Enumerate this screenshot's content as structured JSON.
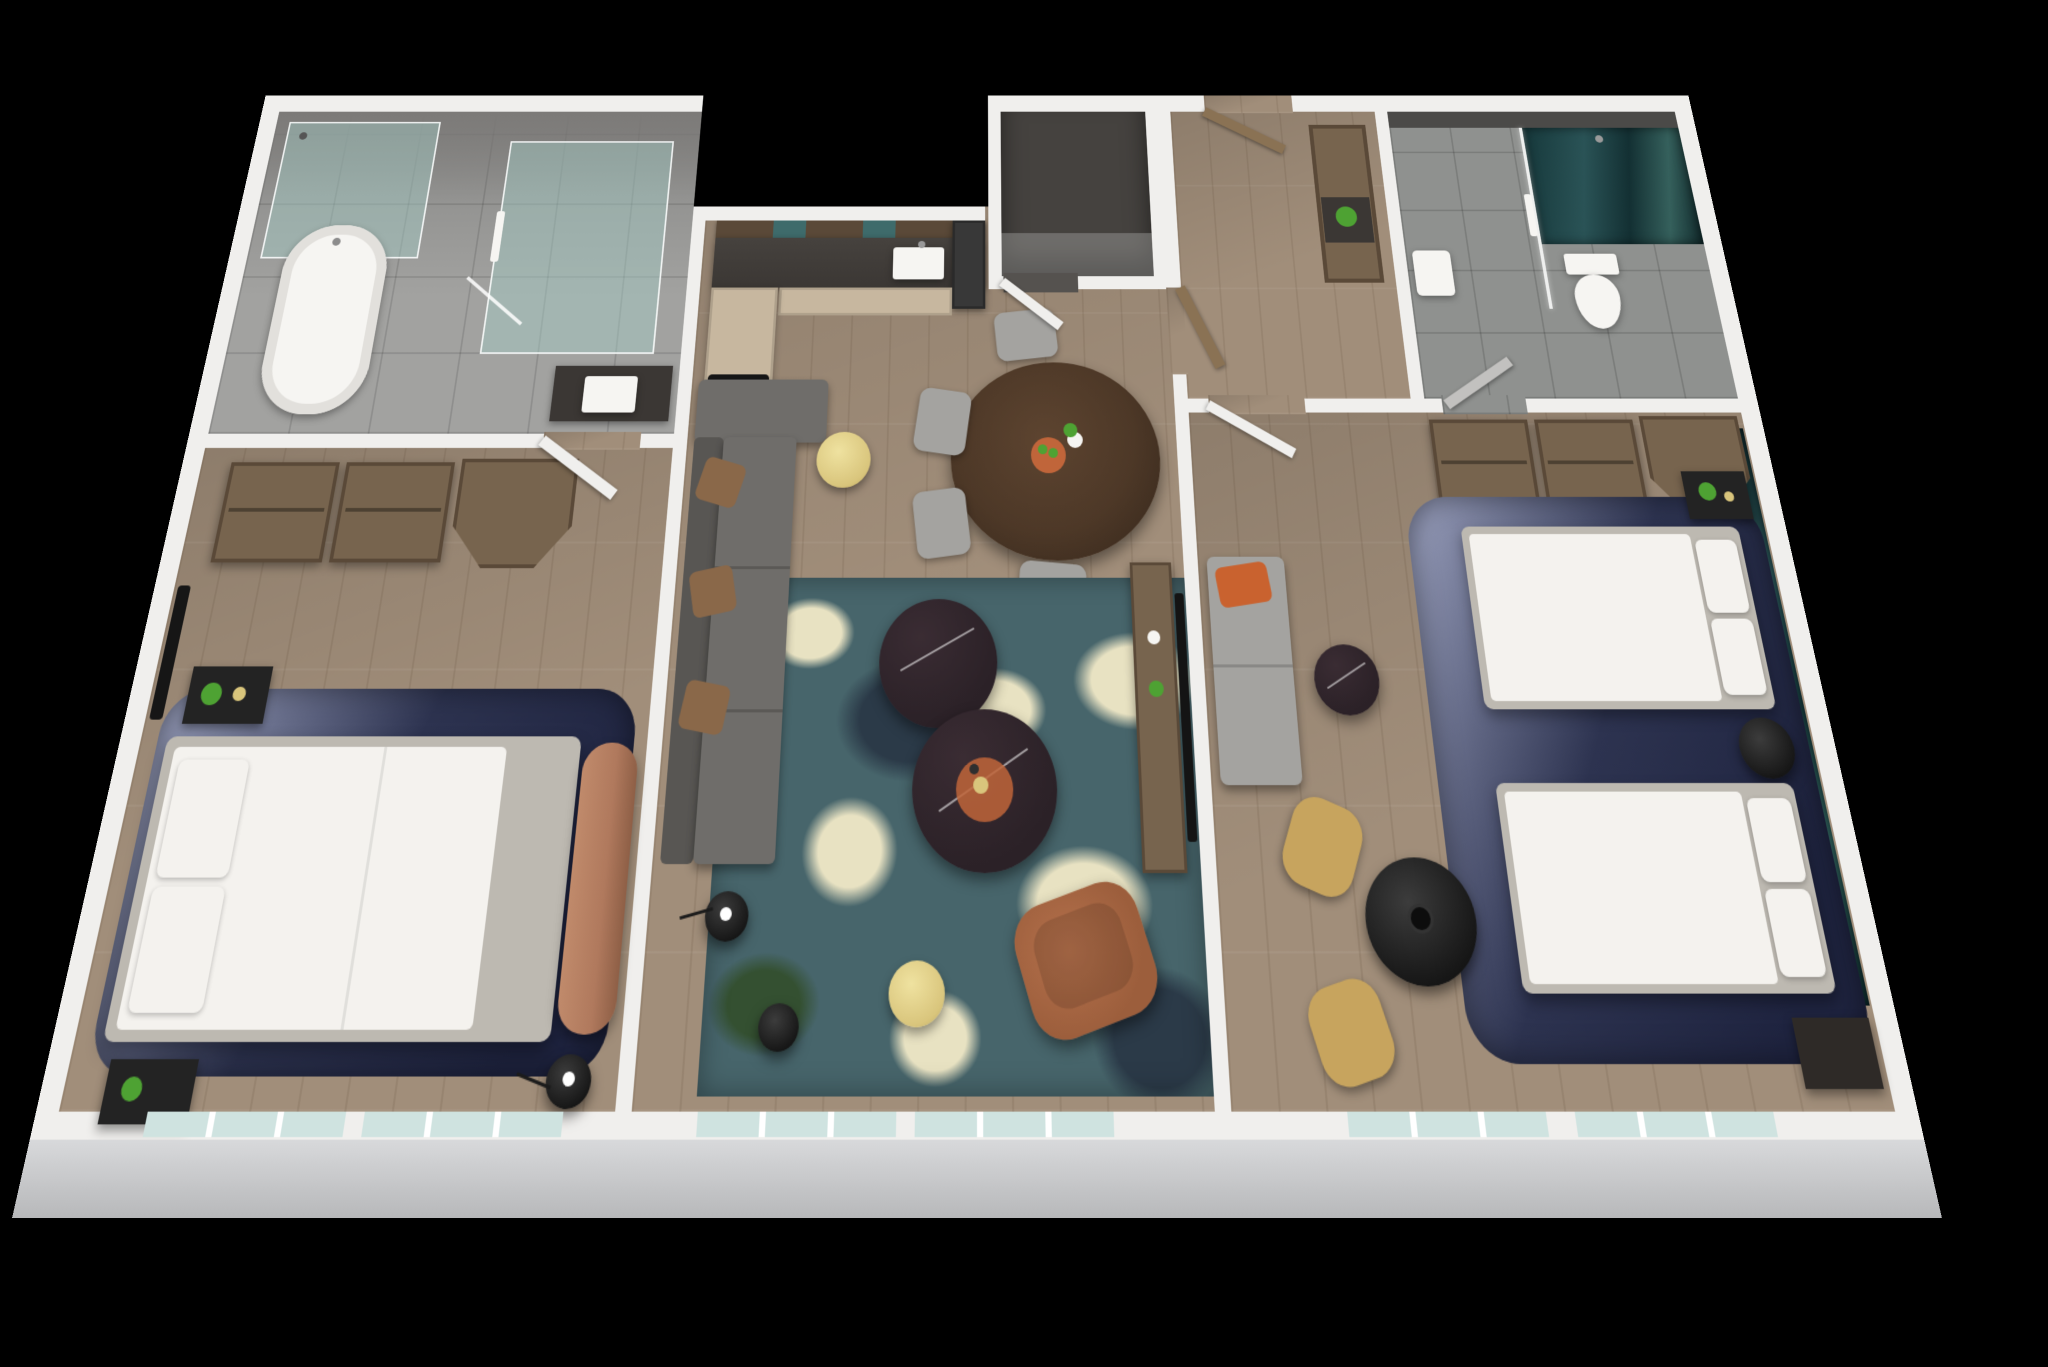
{
  "scene": {
    "type": "3d-floorplan-render",
    "description": "Isometric top-down 3D rendering of a two-bedroom hotel suite with white cut walls on a black background",
    "background": "#000000",
    "view": "angled top-down perspective, windows along the front (bottom) wall"
  },
  "palette": {
    "wall": "#f0efed",
    "exteriorFaceTop": "#d8d9db",
    "exteriorFaceBottom": "#b7b8ba",
    "blackVoid": "#000000",
    "woodFloor": "#a18e7a",
    "tileFloor": "#a2a2a0",
    "tileFloor2": "#8f918f",
    "darkWallFace": "#7c7a78",
    "closetInterior": "#45423f",
    "stoneCounter": "#3b3734",
    "cabinetBeige": "#c7b79f",
    "woodCabinet": "#77644e",
    "woodCabinetDark": "#5a4938",
    "tealGlassCabinet": "#3e6b6b",
    "applianceDark": "#383838",
    "glassTint": "rgba(164,205,198,0.45)",
    "glassEdge": "rgba(255,255,255,0.85)",
    "tealDeep": "#1d3d40",
    "navyRug": "#2d3350",
    "navyRugLight": "#8d93b0",
    "rugTeal": "#47656b",
    "rugCream": "#e8e2c2",
    "rugNavy": "#2b3a48",
    "rugGreen": "#345031",
    "sofaGray": "#6f6d6a",
    "sofaGrayDark": "#585653",
    "pillowBrown": "#8a6849",
    "leatherChair": "#9c5e3c",
    "copperBench": "#b0795d",
    "gold": "#d9c57c",
    "marbleDark": "#2b2127",
    "mattressWhite": "#f4f2ee",
    "bedFrame": "#bdb9b1",
    "matteBlack": "#232323",
    "mustard": "#c7a45e",
    "chairGray": "#a4a3a0",
    "plantGreen": "#4ea233",
    "terracotta": "#c0653a",
    "orangePillow": "#c9622f",
    "windowGlass": "#cfe3e0",
    "doorWood": "#8a7254",
    "white": "#f6f5f2",
    "diningWood": "#4d3827"
  },
  "rooms": [
    {
      "id": "bathroom-1",
      "name": "Master Bathroom",
      "floor": "stone tile",
      "furniture": [
        "freestanding bathtub",
        "corner glass shower",
        "walk-in glass shower with towel rail",
        "vanity with white sink",
        "swing door"
      ]
    },
    {
      "id": "bedroom-1",
      "name": "Master Bedroom",
      "floor": "wood plank",
      "furniture": [
        "two open wardrobes",
        "angled walk-in closet",
        "wall TV",
        "king bed with white linens",
        "two black nightstands",
        "copper leather bench",
        "navy area rug",
        "black floor lamp",
        "potted plant"
      ]
    },
    {
      "id": "kitchen",
      "name": "Kitchen",
      "floor": "wood plank",
      "furniture": [
        "upper cabinets with teal glass",
        "dark stone counter",
        "sink with faucet",
        "refrigerator",
        "beige base cabinets",
        "four-burner cooktop"
      ]
    },
    {
      "id": "utility-closet",
      "name": "Utility Closet",
      "floor": "dark",
      "furniture": [
        "open white door"
      ]
    },
    {
      "id": "entry-hall",
      "name": "Entry Hall",
      "floor": "wood plank",
      "furniture": [
        "entry door",
        "console niche with plant",
        "wood pocket door"
      ]
    },
    {
      "id": "bathroom-2",
      "name": "Second Bathroom",
      "floor": "stone tile",
      "furniture": [
        "glass shower with teal feature wall",
        "glass partition",
        "toilet",
        "wall sink",
        "swing door"
      ]
    },
    {
      "id": "bedroom-2",
      "name": "Second Bedroom (two queens)",
      "floor": "wood plank",
      "furniture": [
        "open wardrobes",
        "angled closet",
        "queen bed A",
        "queen bed B",
        "black nightstand with plant",
        "round black nightstand",
        "navy area rug",
        "gray sleeper sofa with orange pillow",
        "marble side table",
        "round black table with vase",
        "two mustard chairs",
        "dark dresser",
        "ocean artwork accent wall"
      ]
    },
    {
      "id": "living-dining",
      "name": "Living / Dining",
      "floor": "wood plank",
      "furniture": [
        "oval dark-wood dining table",
        "fruit bowl and plant",
        "four gray dining chairs",
        "gray sectional sofa with brown pillows",
        "gold round side tables",
        "two round marble coffee tables",
        "copper tray with drinks",
        "abstract teal-cream rug",
        "cognac leather armchair",
        "black floor lamps",
        "media console with TV, vase and plant"
      ]
    }
  ],
  "windows": {
    "south_wall_count": 6,
    "style": "full-height glazing with white mullions"
  }
}
